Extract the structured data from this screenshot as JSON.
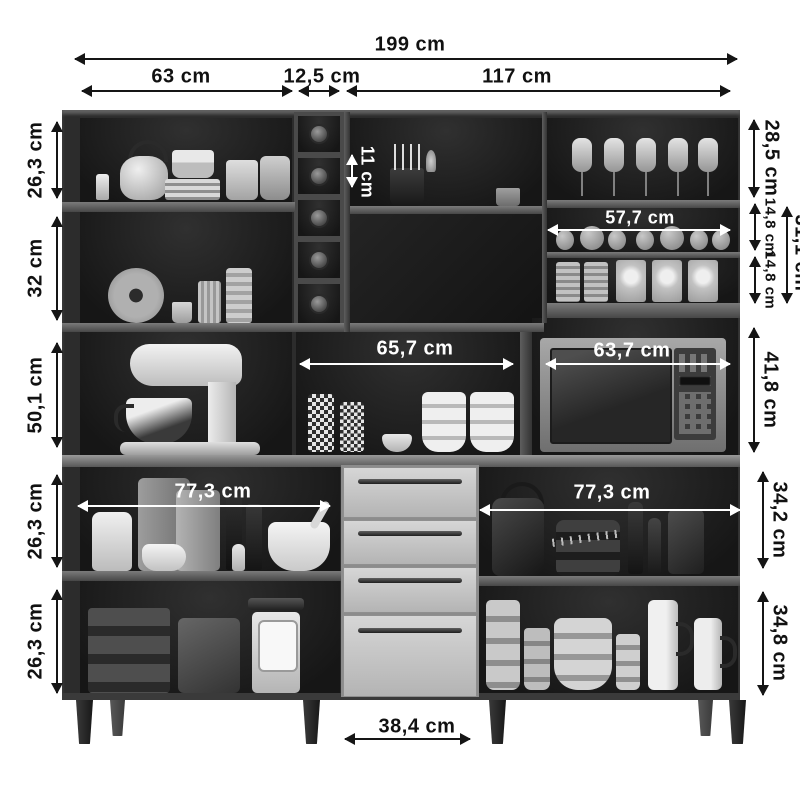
{
  "diagram": {
    "subject": "Kitchen cabinet hutch with dimension annotations",
    "unit": "cm",
    "style": "grayscale product photo with black outer and white inner dimension arrows"
  },
  "dims": {
    "total_width": "199 cm",
    "top_left_width": "63 cm",
    "top_center_width": "12,5 cm",
    "top_right_width": "117 cm",
    "left_shelf1_height": "26,3 cm",
    "left_shelf2_height": "32 cm",
    "left_shelf3_height": "50,1 cm",
    "base_left_shelf1_height": "26,3 cm",
    "base_left_shelf2_height": "26,3 cm",
    "right_top_height": "28,5 cm",
    "spice_shelf1_height": "14,8 cm",
    "spice_shelf2_height": "14,8 cm",
    "spice_total_height": "31,1 cm",
    "microwave_compartment_height": "41,8 cm",
    "base_right_shelf1_height": "34,2 cm",
    "base_right_shelf2_height": "34,8 cm",
    "wine_rack_inner_height": "11 cm",
    "spice_shelf_width": "57,7 cm",
    "middle_shelf_width": "65,7 cm",
    "microwave_compartment_width": "63,7 cm",
    "base_left_shelf_width": "77,3 cm",
    "base_right_shelf_width": "77,3 cm",
    "drawer_width": "38,4 cm"
  },
  "colors": {
    "background": "#ffffff",
    "cabinet_dark": "#262626",
    "shelf_board": "#5e5e5e",
    "drawer_front": "#c7c7c7",
    "dimension_text": "#111111",
    "inner_dimension_text": "#ffffff"
  }
}
